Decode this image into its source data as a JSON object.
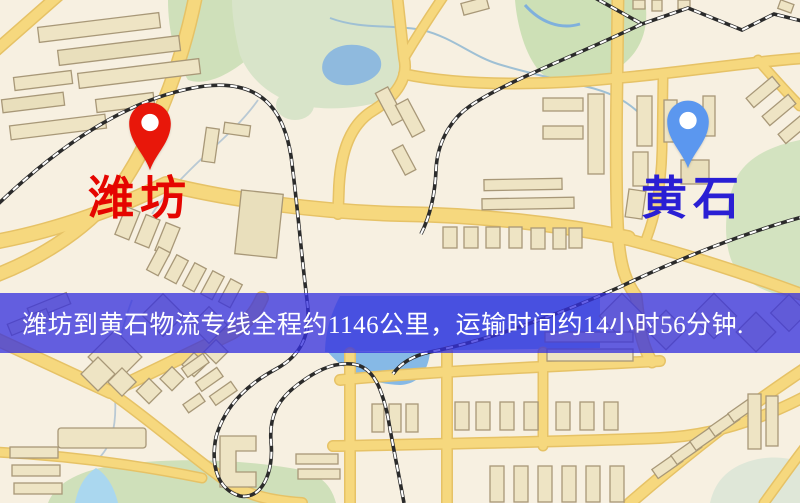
{
  "map": {
    "origin_marker": {
      "label": "潍坊",
      "pin_color": "#e8170a",
      "pin_inner_color": "#ffffff",
      "label_color": "#e50500"
    },
    "destination_marker": {
      "label": "黄石",
      "pin_color": "#5b97ef",
      "pin_inner_color": "#ffffff",
      "label_color": "#2a1fd4"
    },
    "banner": {
      "text": "潍坊到黄石物流专线全程约1146公里，运输时间约14小时56分钟.",
      "origin": "潍坊",
      "destination": "黄石",
      "distance": "约1146公里",
      "duration": "约14小时56分钟",
      "background": "rgba(52,47,222,0.76)",
      "text_color": "#ffffff"
    }
  }
}
